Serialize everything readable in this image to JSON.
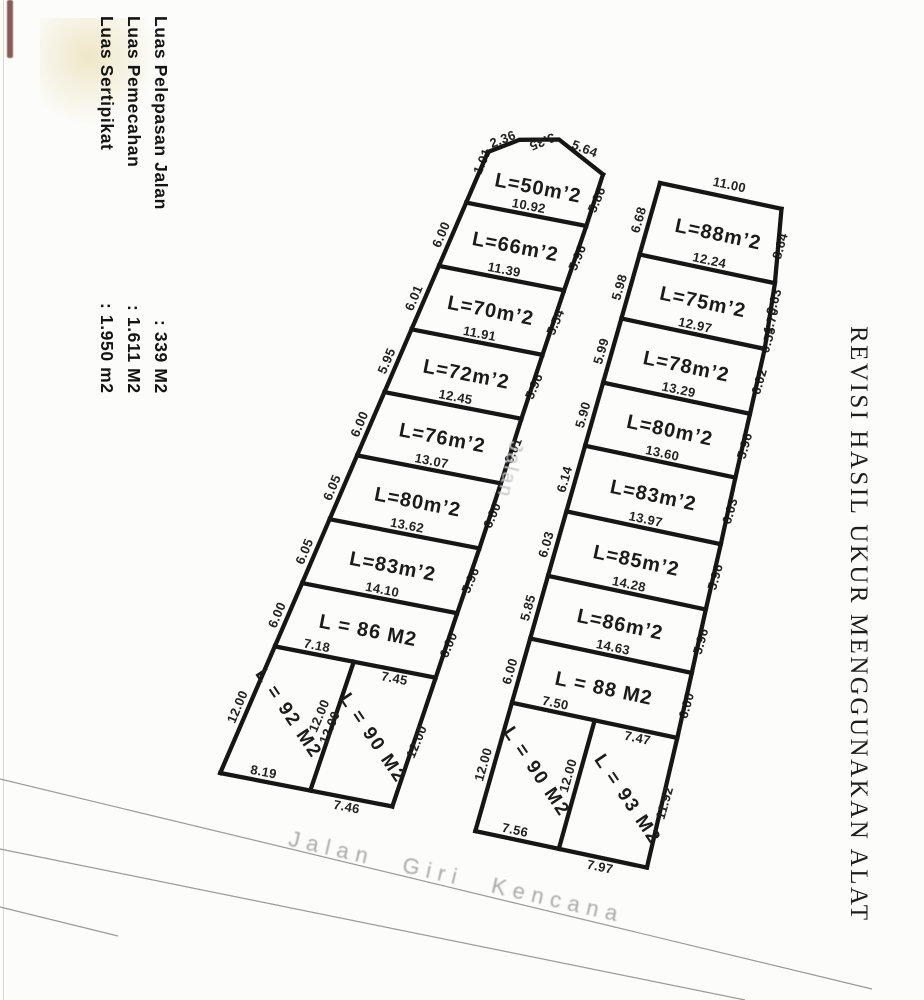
{
  "annotations": {
    "left_notes": [
      {
        "label": "Luas Sertipikat",
        "value": ": 1.950 m2"
      },
      {
        "label": "Luas Pemecahan",
        "value": ": 1.611 M2"
      },
      {
        "label": "Luas Pelepasan Jalan",
        "value": ": 339 M2"
      }
    ],
    "side_note": "REVISI HASIL UKUR MENGGUNAKAN ALAT",
    "road_center": "Jalan",
    "road_bottom": "Jalan Giri Kencana"
  },
  "colors": {
    "ink": "#161616",
    "faint_text": "#aaaaaa",
    "road_line": "#9a9a9a",
    "artifact": "#6b3430"
  },
  "strips": {
    "left": {
      "top_edge_dims": [
        "1.01",
        "2.36",
        "3.35",
        "5.64"
      ],
      "rows": [
        {
          "area": "L=50m’2",
          "width": "10.92",
          "left": "",
          "right": "5.86"
        },
        {
          "area": "L=66m’2",
          "width": "11.39",
          "left": "6.00",
          "right": "5.96"
        },
        {
          "area": "L=70m’2",
          "width": "11.91",
          "left": "6.01",
          "right": "5.54"
        },
        {
          "area": "L=72m’2",
          "width": "12.45",
          "left": "5.95",
          "right": "5.96"
        },
        {
          "area": "L=76m’2",
          "width": "13.07",
          "left": "6.00",
          "right": "6.01"
        },
        {
          "area": "L=80m’2",
          "width": "13.62",
          "left": "6.05",
          "right": "6.00"
        },
        {
          "area": "L=83m’2",
          "width": "14.10",
          "left": "6.05",
          "right": "5.96"
        },
        {
          "area": "L = 86 M2",
          "left": "6.00",
          "right": "6.00",
          "split": [
            "7.18",
            "7.45"
          ]
        }
      ],
      "bottom_plots": {
        "depth": "12.00",
        "left_dim": "12.00",
        "divider_dims": [
          "12.00",
          "12.00"
        ],
        "right_dim": "12.00",
        "plots": [
          {
            "area": "L = 92 M2",
            "bottom": "8.19"
          },
          {
            "area": "L = 90 M2",
            "bottom": "7.46"
          }
        ]
      }
    },
    "right": {
      "top_dim": "11.00",
      "rows": [
        {
          "area": "L=88m’2",
          "width": "12.24",
          "left": "6.68",
          "right": "8.64"
        },
        {
          "area": "L=75m’2",
          "width": "12.97",
          "left": "5.98",
          "right": "3.63",
          "right_extra": [
            "1.70",
            "0.55"
          ]
        },
        {
          "area": "L=78m’2",
          "width": "13.29",
          "left": "5.99",
          "right": "6.02"
        },
        {
          "area": "L=80m’2",
          "width": "13.60",
          "left": "5.90",
          "right": "5.96"
        },
        {
          "area": "L=83m’2",
          "width": "13.97",
          "left": "6.14",
          "right": "6.03"
        },
        {
          "area": "L=85m’2",
          "width": "14.28",
          "left": "6.03",
          "right": "5.96"
        },
        {
          "area": "L=86m’2",
          "width": "14.63",
          "left": "5.85",
          "right": "5.96"
        },
        {
          "area": "L = 88 M2",
          "left": "6.00",
          "right": "6.00",
          "split": [
            "7.50",
            "7.47"
          ]
        }
      ],
      "bottom_plots": {
        "depth": "12.00",
        "left_dim": "12.00",
        "divider_dims": [
          "12.00"
        ],
        "right_dim": "11.92",
        "plots": [
          {
            "area": "L = 90 M2",
            "bottom": "7.56"
          },
          {
            "area": "L = 93 M2",
            "bottom": "7.97"
          }
        ]
      }
    }
  }
}
